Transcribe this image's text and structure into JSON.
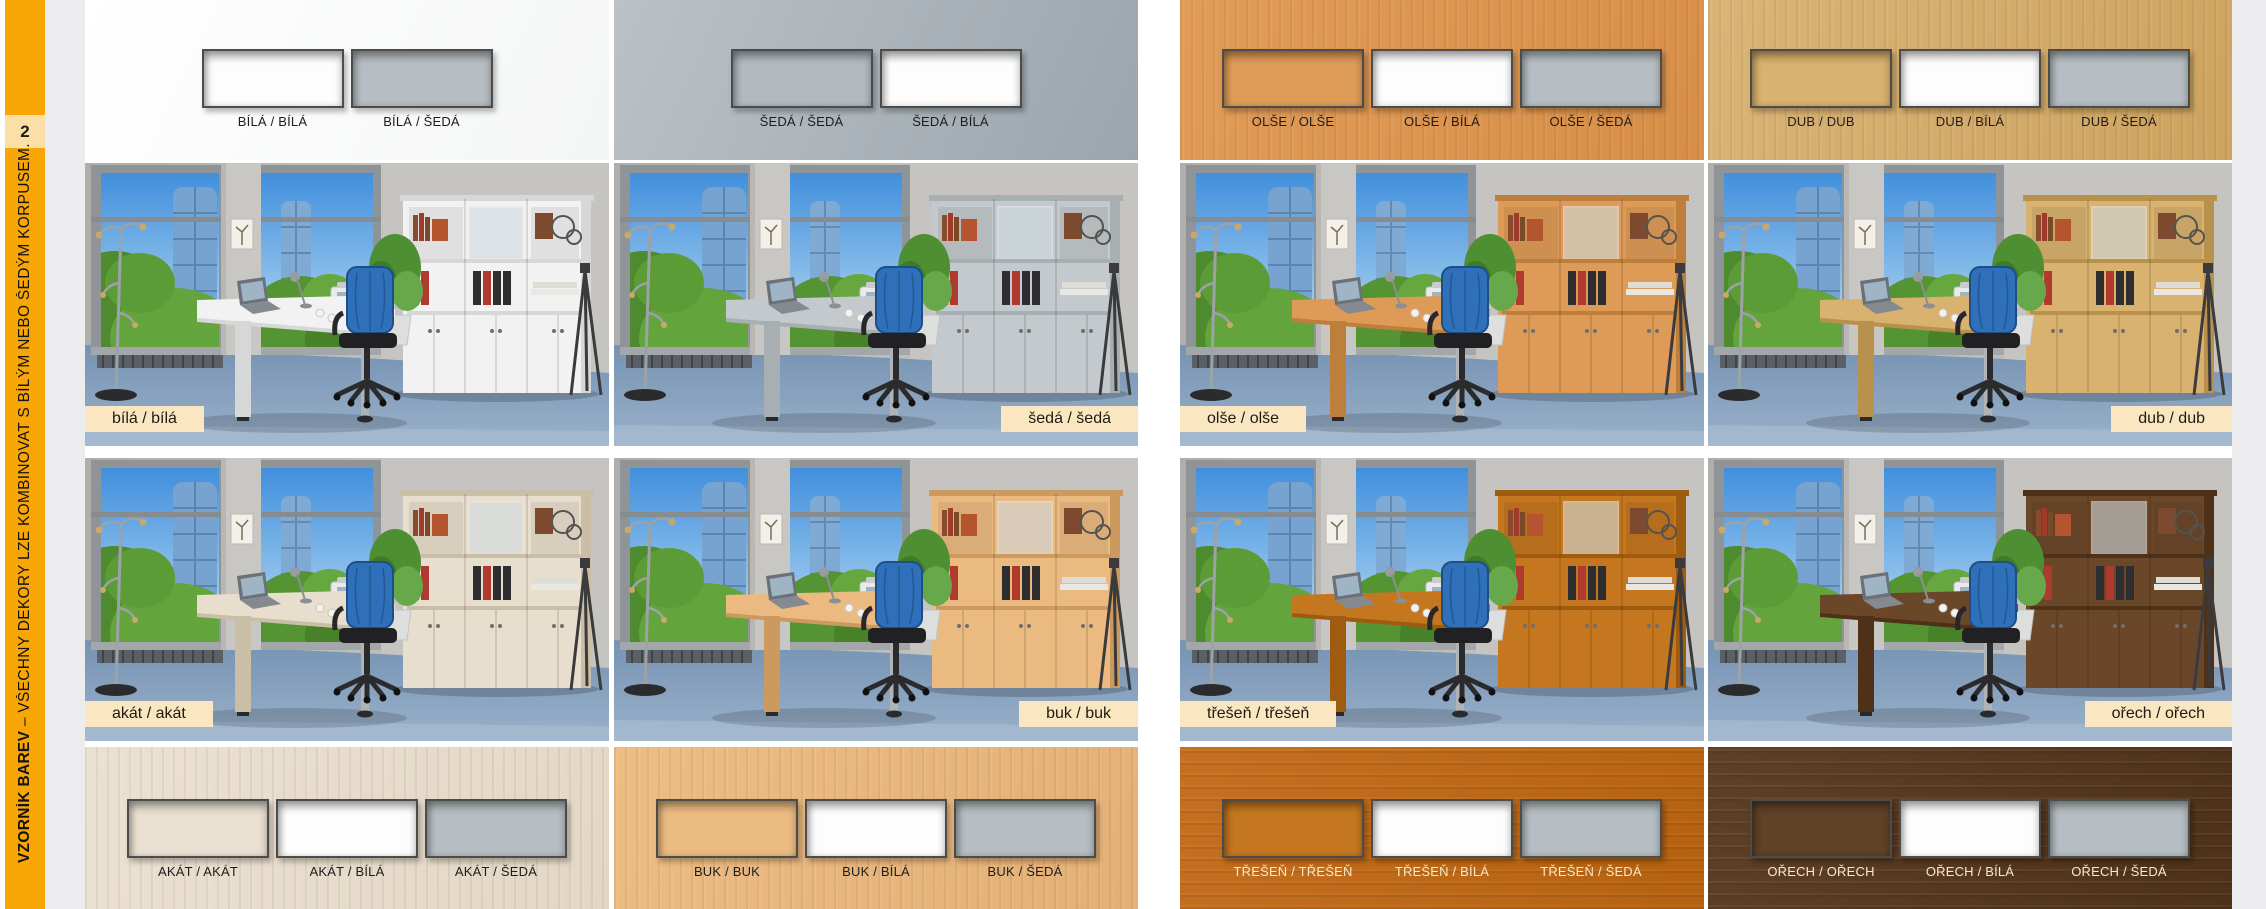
{
  "page": {
    "background": "#FFFFFF",
    "gutter_color": "#ECECEE",
    "tag_bg": "#FAE7C2",
    "sidebar": {
      "bg": "#F7A606",
      "page_number": "2",
      "page_number_bg": "#FBDFA6",
      "title_bold": "VZORNÍK BAREV",
      "title_rest": " – VŠECHNY DEKORY LZE KOMBINOVAT S BÍLÝM NEBO ŠEDÝM KORPUSEM."
    }
  },
  "columns": [
    {
      "top": {
        "bg": "#FFFFFF",
        "bg2": "#F4F5F5",
        "label_color": "#1D1D1B",
        "swatches": [
          {
            "label": "BÍLÁ / BÍLÁ",
            "fill": "#FDFDFD"
          },
          {
            "label": "BÍLÁ / ŠEDÁ",
            "fill": "#B6BEC3"
          }
        ]
      },
      "rooms": [
        {
          "tag": "bílá / bílá",
          "furniture": "#F1F2F1",
          "furniture_dark": "#D5D8D7",
          "tag_side": "left"
        },
        {
          "tag": "akát / akát",
          "furniture": "#E8DECD",
          "furniture_dark": "#CBBEA7",
          "tag_side": "left"
        }
      ],
      "bottom": {
        "bg": "#EBE1D2",
        "bg2": "#E3D7C4",
        "label_color": "#1D1D1B",
        "grain": "v",
        "swatches": [
          {
            "label": "AKÁT / AKÁT",
            "fill": "#EAE0D1"
          },
          {
            "label": "AKÁT / BÍLÁ",
            "fill": "#FDFDFD"
          },
          {
            "label": "AKÁT / ŠEDÁ",
            "fill": "#B6BEC3"
          }
        ]
      }
    },
    {
      "top": {
        "bg": "#BAC2C7",
        "bg2": "#9CA5AC",
        "label_color": "#1D1D1B",
        "swatches": [
          {
            "label": "ŠEDÁ / ŠEDÁ",
            "fill": "#B2BAC0"
          },
          {
            "label": "ŠEDÁ / BÍLÁ",
            "fill": "#FDFDFD"
          }
        ]
      },
      "rooms": [
        {
          "tag": "šedá / šedá",
          "furniture": "#C3C9CC",
          "furniture_dark": "#A8AFB3",
          "tag_side": "right"
        },
        {
          "tag": "buk / buk",
          "furniture": "#EBBA80",
          "furniture_dark": "#CC9A5E",
          "tag_side": "right"
        }
      ],
      "bottom": {
        "bg": "#EDBD85",
        "bg2": "#E4B075",
        "label_color": "#1D1D1B",
        "grain": "v",
        "swatches": [
          {
            "label": "BUK / BUK",
            "fill": "#ECBB81"
          },
          {
            "label": "BUK / BÍLÁ",
            "fill": "#FDFDFD"
          },
          {
            "label": "BUK / ŠEDÁ",
            "fill": "#B6BEC3"
          }
        ]
      }
    },
    {
      "top": {
        "bg": "#E29C58",
        "bg2": "#D88E47",
        "label_color": "#1D1D1B",
        "grain": "v",
        "swatches": [
          {
            "label": "OLŠE / OLŠE",
            "fill": "#DF9C58"
          },
          {
            "label": "OLŠE / BÍLÁ",
            "fill": "#FDFDFD"
          },
          {
            "label": "OLŠE / ŠEDÁ",
            "fill": "#B6BEC3"
          }
        ]
      },
      "rooms": [
        {
          "tag": "olše / olše",
          "furniture": "#DE9B57",
          "furniture_dark": "#BE7E3C",
          "tag_side": "left"
        },
        {
          "tag": "třešeň / třešeň",
          "furniture": "#C4771F",
          "furniture_dark": "#9F5C10",
          "tag_side": "left"
        }
      ],
      "bottom": {
        "bg": "#C57020",
        "bg2": "#B5610F",
        "label_color": "#F9E9C6",
        "grain": "h",
        "swatches": [
          {
            "label": "TŘEŠEŇ / TŘEŠEŇ",
            "fill": "#C4771F"
          },
          {
            "label": "TŘEŠEŇ / BÍLÁ",
            "fill": "#FDFDFD"
          },
          {
            "label": "TŘEŠEŇ / ŠEDÁ",
            "fill": "#B6BEC3"
          }
        ]
      }
    },
    {
      "top": {
        "bg": "#DAB477",
        "bg2": "#CEA35E",
        "label_color": "#1D1D1B",
        "grain": "v",
        "swatches": [
          {
            "label": "DUB / DUB",
            "fill": "#D8B26E"
          },
          {
            "label": "DUB / BÍLÁ",
            "fill": "#FDFDFD"
          },
          {
            "label": "DUB / ŠEDÁ",
            "fill": "#B6BEC3"
          }
        ]
      },
      "rooms": [
        {
          "tag": "dub / dub",
          "furniture": "#D8B26E",
          "furniture_dark": "#B8914C",
          "tag_side": "right"
        },
        {
          "tag": "ořech / ořech",
          "furniture": "#6B472A",
          "furniture_dark": "#4E3118",
          "tag_side": "right"
        }
      ],
      "bottom": {
        "bg": "#5E4027",
        "bg2": "#4E3119",
        "label_color": "#F9E9C6",
        "grain": "h",
        "swatches": [
          {
            "label": "OŘECH / OŘECH",
            "fill": "#5F4227"
          },
          {
            "label": "OŘECH / BÍLÁ",
            "fill": "#FDFDFD"
          },
          {
            "label": "OŘECH / ŠEDÁ",
            "fill": "#B6BEC3"
          }
        ]
      }
    }
  ]
}
